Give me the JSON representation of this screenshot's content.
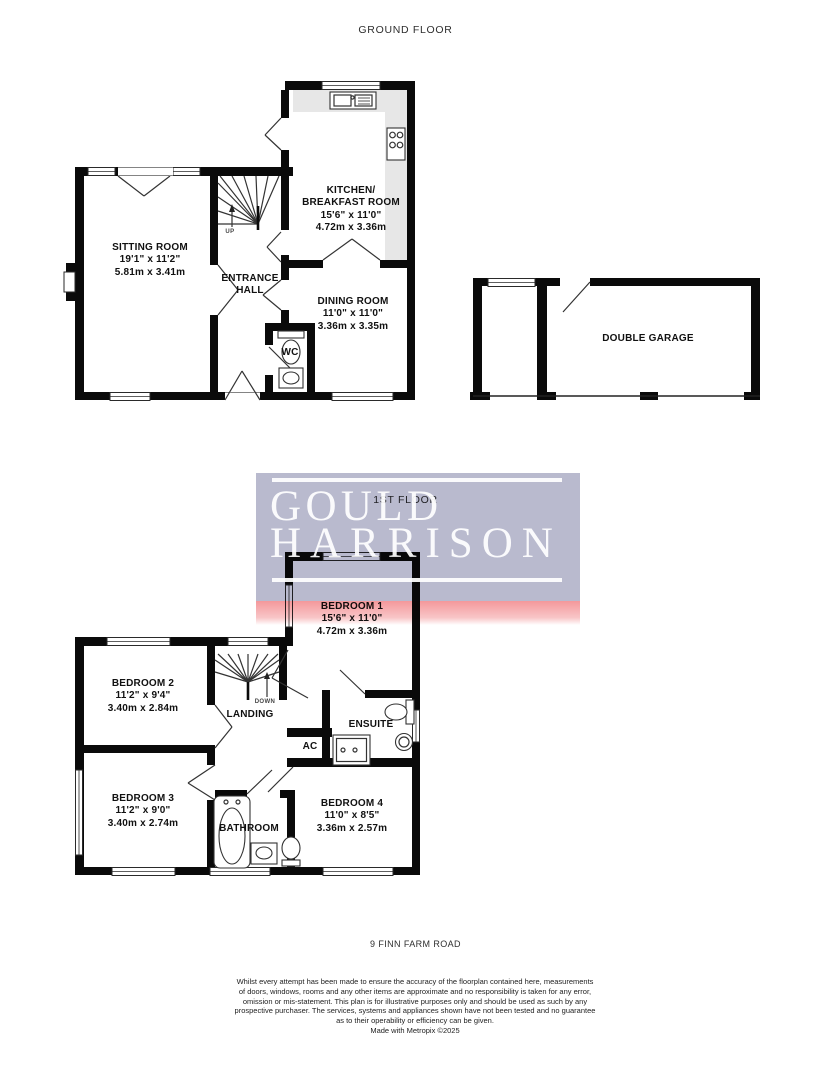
{
  "colors": {
    "wall": "#0a0a0a",
    "line": "#333333",
    "counter": "#e7e7e7",
    "label": "#111111",
    "watermark_lavender": "#b9bace",
    "watermark_pink_top": "#f4989b",
    "watermark_text": "rgba(255,255,255,0.93)"
  },
  "titles": {
    "ground_floor": "GROUND FLOOR",
    "first_floor": "1ST FLOOR",
    "address": "9 FINN FARM ROAD"
  },
  "watermark": {
    "word1": "GOULD",
    "word2": "HARRISON"
  },
  "ground_floor": {
    "sitting_room": {
      "name": "SITTING ROOM",
      "imperial": "19'1\" x 11'2\"",
      "metric": "5.81m x 3.41m"
    },
    "entrance_hall": {
      "line1": "ENTRANCE",
      "line2": "HALL"
    },
    "kitchen": {
      "line1": "KITCHEN/",
      "line2": "BREAKFAST ROOM",
      "imperial": "15'6\" x 11'0\"",
      "metric": "4.72m x 3.36m"
    },
    "dining_room": {
      "name": "DINING ROOM",
      "imperial": "11'0\" x 11'0\"",
      "metric": "3.36m x 3.35m"
    },
    "wc": {
      "name": "WC"
    },
    "garage": {
      "name": "DOUBLE GARAGE"
    },
    "stairs": {
      "label": "UP"
    }
  },
  "first_floor": {
    "bedroom1": {
      "name": "BEDROOM 1",
      "imperial": "15'6\" x 11'0\"",
      "metric": "4.72m x 3.36m"
    },
    "bedroom2": {
      "name": "BEDROOM 2",
      "imperial": "11'2\" x 9'4\"",
      "metric": "3.40m x 2.84m"
    },
    "bedroom3": {
      "name": "BEDROOM 3",
      "imperial": "11'2\" x 9'0\"",
      "metric": "3.40m x 2.74m"
    },
    "bedroom4": {
      "name": "BEDROOM 4",
      "imperial": "11'0\" x 8'5\"",
      "metric": "3.36m x 2.57m"
    },
    "landing": {
      "name": "LANDING"
    },
    "ensuite": {
      "name": "ENSUITE"
    },
    "airing_cupboard": {
      "name": "AC"
    },
    "bathroom": {
      "name": "BATHROOM"
    },
    "stairs": {
      "label": "DOWN"
    }
  },
  "footer": {
    "disclaimer_lines": [
      "Whilst every attempt has been made to ensure the accuracy of the floorplan contained here, measurements",
      "of doors, windows, rooms and any other items are approximate and no responsibility is taken for any error,",
      "omission or mis-statement. This plan is for illustrative purposes only and should be used as such by any",
      "prospective purchaser. The services, systems and appliances shown have not been tested and no guarantee",
      "as to their operability or efficiency can be given."
    ],
    "credit": "Made with Metropix ©2025"
  }
}
